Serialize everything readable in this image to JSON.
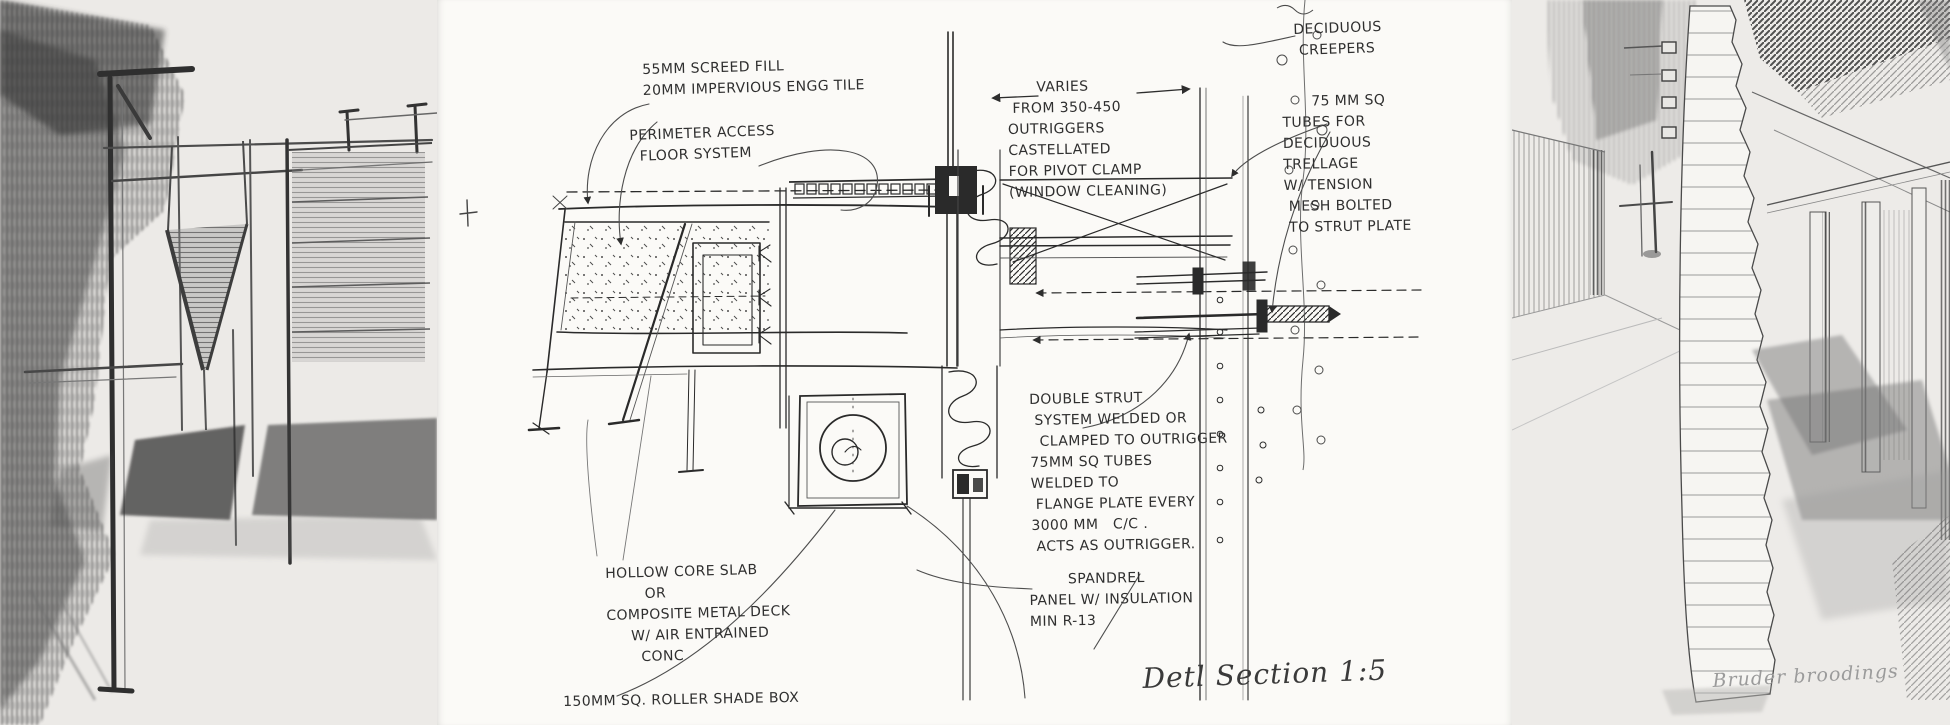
{
  "artwork": {
    "center_panel": {
      "screed_note": "55MM SCREED FILL\n20MM IMPERVIOUS ENGG TILE",
      "perimeter_note": "PERIMETER ACCESS\n  FLOOR SYSTEM",
      "varies_note": "      VARIES\n FROM 350-450\nOUTRIGGERS\nCASTELLATED\nFOR PIVOT CLAMP\n(WINDOW CLEANING)",
      "creepers_note": "DECIDUOUS\n CREEPERS",
      "trellage_note": "      75 MM SQ\nTUBES FOR\nDECIDUOUS\nTRELLAGE\nW/ TENSION\n MESH BOLTED\n TO STRUT PLATE",
      "strut_note": "DOUBLE STRUT\n SYSTEM WELDED OR\n  CLAMPED TO OUTRIGGER\n75MM SQ TUBES\nWELDED TO\n FLANGE PLATE EVERY\n3000 MM   C/C .\n ACTS AS OUTRIGGER.",
      "spandrel_note": "        SPANDREL\nPANEL W/ INSULATION\nMIN R-13",
      "slab_note": "HOLLOW CORE SLAB\n        OR\nCOMPOSITE METAL DECK\n     W/ AIR ENTRAINED\n       CONC",
      "roller_note": "150MM SQ. ROLLER SHADE BOX",
      "title": "Detl Section 1:5"
    },
    "right_panel": {
      "signature": "Bruder broodings"
    }
  },
  "colors": {
    "ink": "#2d2d2d",
    "pencil": "#5f5f5f",
    "paper_side": "#eceae7",
    "paper_center": "#fbfaf7"
  }
}
